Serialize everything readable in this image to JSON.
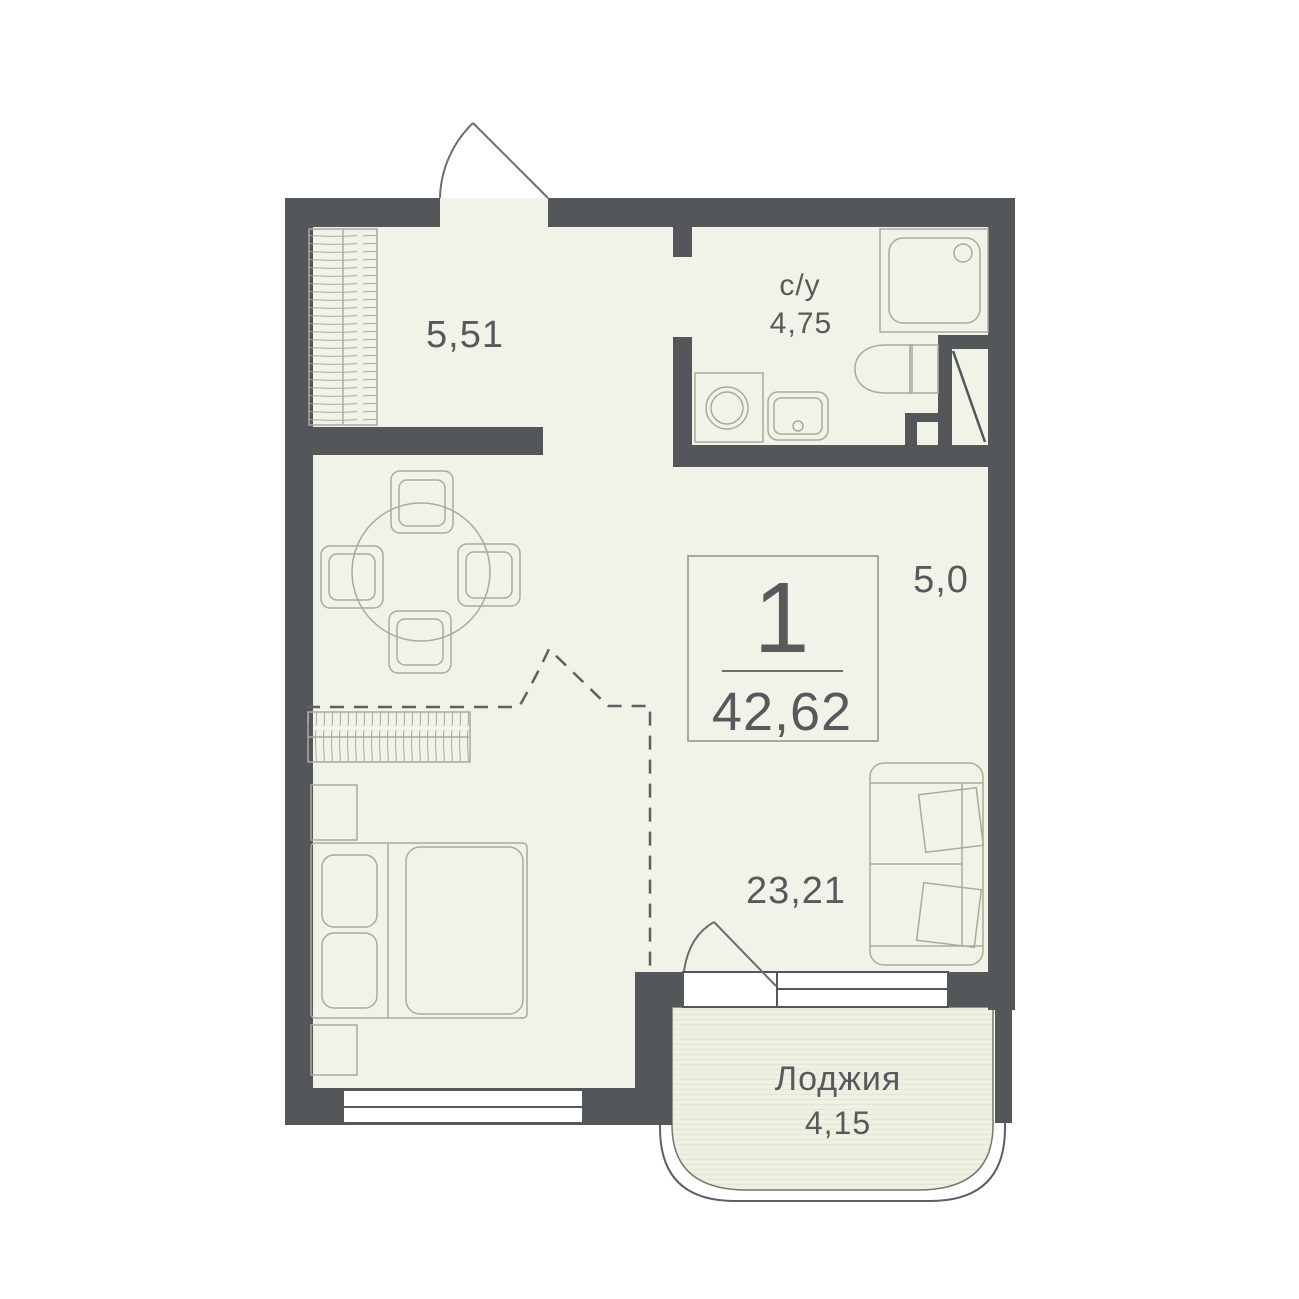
{
  "unit": {
    "rooms_count": "1",
    "total_area": "42,62"
  },
  "labels": {
    "hallway_area": "5,51",
    "bathroom_name": "с/у",
    "bathroom_area": "4,75",
    "kitchen_area": "5,0",
    "living_area": "23,21",
    "loggia_name": "Лоджия",
    "loggia_area": "4,15"
  },
  "furniture_icons": [
    "wardrobe-icon",
    "dining-table-icon",
    "chair-icon",
    "dresser-icon",
    "double-bed-icon",
    "nightstand-icon",
    "sofa-icon",
    "washing-machine-icon",
    "sink-icon",
    "toilet-icon",
    "shower-icon",
    "vent-shaft-icon"
  ],
  "colors": {
    "wall": "#54575a",
    "floor": "#f2f3e8",
    "loggia_floor": "#eef0e1",
    "furniture_line": "#a9aa9d",
    "door_line": "#6a6d71",
    "text": "#57595d",
    "background": "#ffffff"
  }
}
